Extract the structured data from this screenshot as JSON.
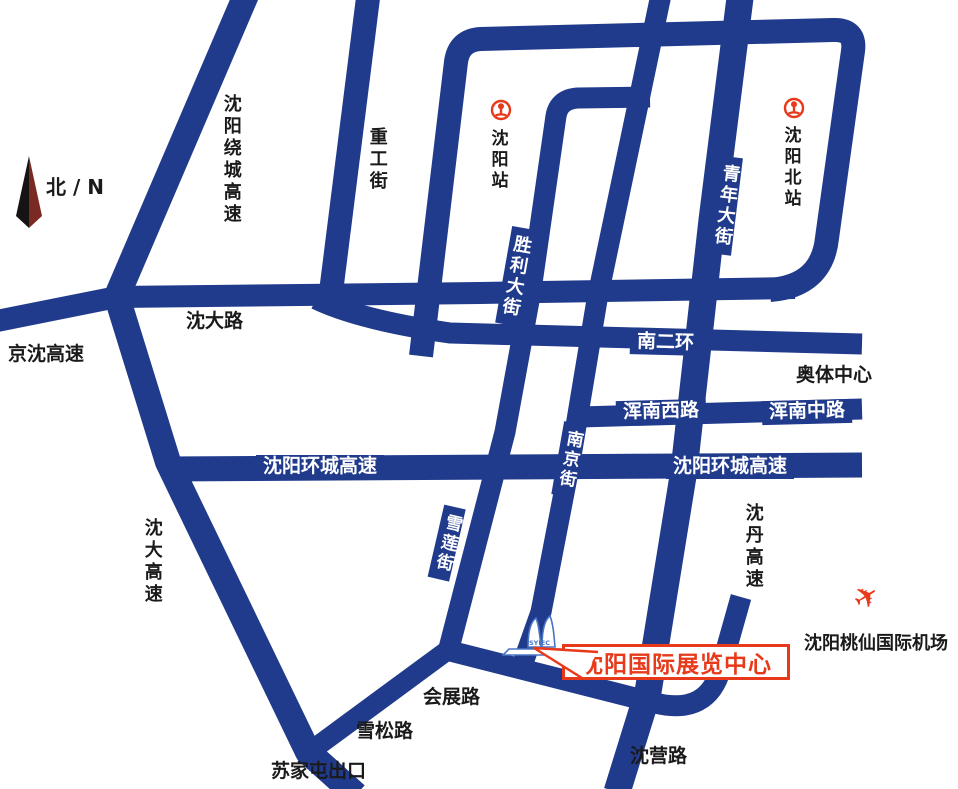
{
  "map": {
    "compass_label": "北 / N",
    "colors": {
      "road_navy": "#203a8c",
      "accent_red": "#e8391a",
      "building_blue": "#4a74c4"
    },
    "stations": {
      "shenyang": "沈阳站",
      "shenyang_north": "沈阳北站"
    },
    "roads": {
      "raocheng": "沈阳绕城高速",
      "zhonggong": "重工街",
      "jingshen": "京沈高速",
      "shendalu": "沈大路",
      "shengli": "胜利大街",
      "qingnian": "青年大街",
      "nanerhuan": "南二环",
      "hunnan_west": "浑南西路",
      "hunnan_middle": "浑南中路",
      "huancheng_west": "沈阳环城高速",
      "huancheng_east": "沈阳环城高速",
      "nanjing": "南京街",
      "xuelian": "雪莲街",
      "shenda": "沈大高速",
      "shendan": "沈丹高速",
      "huizhan": "会展路",
      "xuesong": "雪松路",
      "sujiatun_exit": "苏家屯出口",
      "shenying": "沈营路"
    },
    "landmarks": {
      "olympic_center": "奥体中心",
      "airport": "沈阳桃仙国际机场",
      "exhibition_center": "沈阳国际展览中心",
      "building_sign": "SYIEC"
    }
  }
}
